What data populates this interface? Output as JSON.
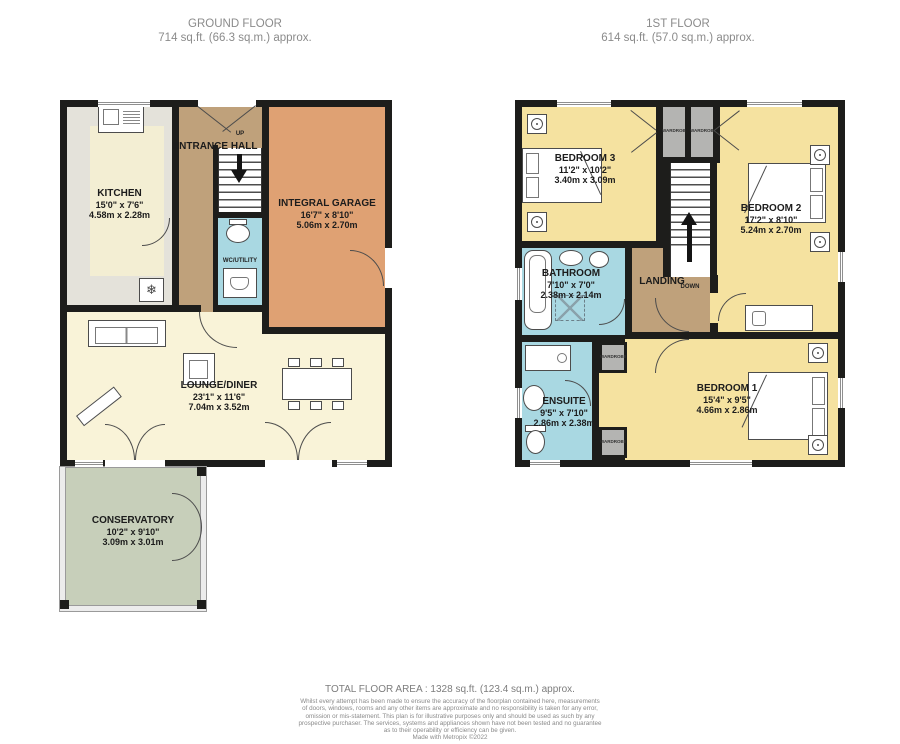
{
  "floors": {
    "ground": {
      "title": "GROUND FLOOR",
      "area": "714 sq.ft. (66.3 sq.m.) approx."
    },
    "first": {
      "title": "1ST FLOOR",
      "area": "614 sq.ft. (57.0 sq.m.) approx."
    }
  },
  "rooms": {
    "kitchen": {
      "name": "KITCHEN",
      "imperial": "15'0\" x 7'6\"",
      "metric": "4.58m x 2.28m"
    },
    "entrance_hall": {
      "name": "ENTRANCE HALL"
    },
    "integral_garage": {
      "name": "INTEGRAL GARAGE",
      "imperial": "16'7\" x 8'10\"",
      "metric": "5.06m x 2.70m"
    },
    "wc_utility": {
      "name": "WC/UTILITY"
    },
    "lounge_diner": {
      "name": "LOUNGE/DINER",
      "imperial": "23'1\" x 11'6\"",
      "metric": "7.04m x 3.52m"
    },
    "conservatory": {
      "name": "CONSERVATORY",
      "imperial": "10'2\" x 9'10\"",
      "metric": "3.09m x 3.01m"
    },
    "bedroom3": {
      "name": "BEDROOM 3",
      "imperial": "11'2\" x 10'2\"",
      "metric": "3.40m x 3.09m"
    },
    "bedroom2": {
      "name": "BEDROOM 2",
      "imperial": "17'2\" x 8'10\"",
      "metric": "5.24m x 2.70m"
    },
    "bathroom": {
      "name": "BATHROOM",
      "imperial": "7'10\" x 7'0\"",
      "metric": "2.38m x 2.14m"
    },
    "landing": {
      "name": "LANDING"
    },
    "ensuite": {
      "name": "ENSUITE",
      "imperial": "9'5\" x 7'10\"",
      "metric": "2.86m x 2.38m"
    },
    "bedroom1": {
      "name": "BEDROOM 1",
      "imperial": "15'4\" x 9'5\"",
      "metric": "4.66m x 2.86m"
    }
  },
  "labels": {
    "up": "UP",
    "down": "DOWN",
    "wardrobe": "WARDROBE"
  },
  "icons": {
    "snowflake": "❄"
  },
  "footer": {
    "total": "TOTAL FLOOR AREA : 1328 sq.ft. (123.4 sq.m.) approx.",
    "disclaimer_lines": [
      "Whilst every attempt has been made to ensure the accuracy of the floorplan contained here, measurements",
      "of doors, windows, rooms and any other items are approximate and no responsibility is taken for any error,",
      "omission or mis-statement. This plan is for illustrative purposes only and should be used as such by any",
      "prospective purchaser. The services, systems and appliances shown have not been tested and no guarantee",
      "as to their operability or efficiency can be given."
    ],
    "credit": "Made with Metropix ©2022"
  },
  "colors": {
    "wall": "#1d1d1b",
    "bedroom": "#f5e2a0",
    "hall": "#bfa17b",
    "garage": "#dfa173",
    "bath": "#a9d8e2",
    "lounge": "#f9f3d8",
    "kitchen_grey": "#e4e2da",
    "kitchen_cream": "#f3eed3",
    "conservatory": "#c7cfba",
    "wardrobe": "#b4b4b2"
  }
}
